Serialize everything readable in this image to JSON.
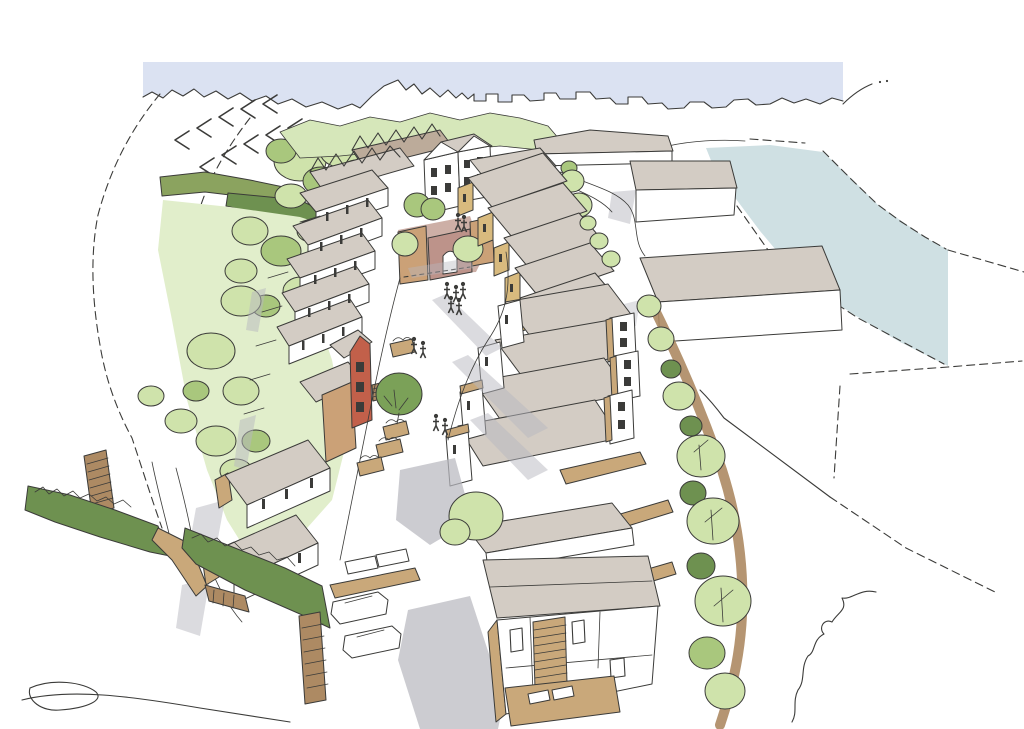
{
  "scene": {
    "description": "Hand-drawn aerial architectural sketch of a proposed housing street: two curving rows of terraced houses with grey mono-pitched roofs facing a central pedestrian street, a pink paved courtyard with archway at the head of the street, ochre gable accents, a terracotta corner house, planters, people and cars, bordered by green hedgerows and tree belts on the left, a tree-lined path on the right, large grey-roofed outbuildings and a pale blue watercourse at the top right, and a pale blue sky band with sketched skyline along the top",
    "elements": [
      "sky-band",
      "skyline",
      "water-course",
      "field-boundary-dashes",
      "hedgerow",
      "tree-belt",
      "hillside-wash",
      "terraced-house-rows",
      "courtyard-plaza",
      "archway",
      "terracotta-house",
      "industrial-buildings",
      "street-planters",
      "street-trees",
      "pedestrians",
      "cars",
      "parking-bays",
      "stepped-footpaths",
      "foreground-house-deck"
    ]
  },
  "palette": {
    "paper": "#ffffff",
    "ink": "#3b3b39",
    "sky": "#dbe2f2",
    "water": "#cfe0e3",
    "roof": "#d3ccc4",
    "roofDark": "#bcab9a",
    "tan": "#d8ba7e",
    "tanSoft": "#c9a87a",
    "wallTan": "#cba177",
    "brown": "#ad8a63",
    "red": "#c2604a",
    "hedge": "#6e9150",
    "hedgeOlive": "#8ba35f",
    "treeLight": "#cfe3ab",
    "treeMid": "#a9c77d",
    "sage": "#7ba158",
    "washGreen": "#e1eecb",
    "bgTrees": "#d6e7ba",
    "pink": "#cdafa6",
    "pinkWall": "#bd938a",
    "shadow": "#b8b8bf"
  }
}
